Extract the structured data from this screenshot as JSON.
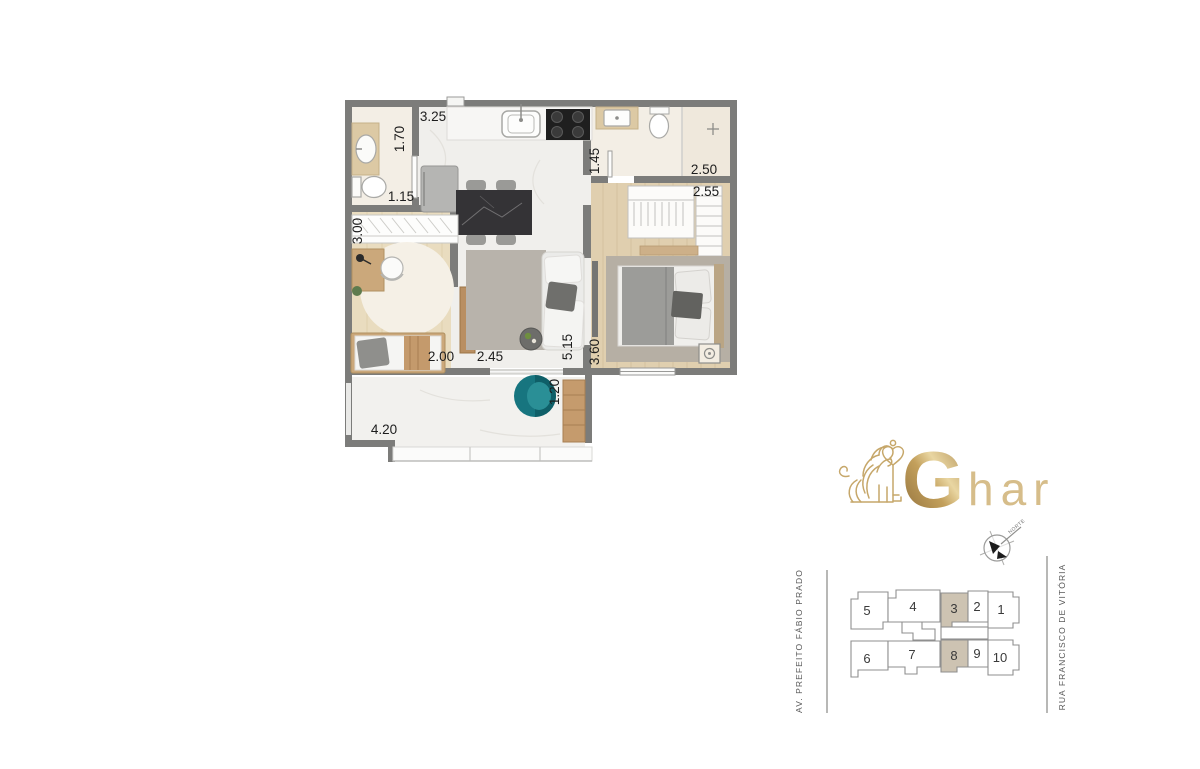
{
  "floor_plan": {
    "dimensions": {
      "kitchen_width": "3.25",
      "bath1_depth": "1.70",
      "bath1_width": "1.15",
      "office_depth": "3.00",
      "office_width": "2.00",
      "living_width": "2.45",
      "living_depth": "5.15",
      "bedroom_depth": "3.60",
      "bath2_depth": "1.45",
      "bath2_width": "2.50",
      "wardrobe_width": "2.55",
      "balcony_depth": "1.20",
      "balcony_width": "4.20"
    },
    "colors": {
      "walls": "#7c7c7a",
      "wood_floor": "#e0cfaf",
      "marble_floor": "#f0efec",
      "bath_floor": "#f3eee5",
      "accent_chair": "#17757f"
    }
  },
  "logo": {
    "initial": "G",
    "suffix": "har",
    "gold": "#c2a262"
  },
  "compass": {
    "label": "NORTE"
  },
  "site_plan": {
    "streets": {
      "left": "AV. PREFEITO FÁBIO PRADO",
      "right": "RUA FRANCISCO DE VITÓRIA"
    },
    "units": [
      {
        "label": "5",
        "highlighted": false
      },
      {
        "label": "4",
        "highlighted": false
      },
      {
        "label": "3",
        "highlighted": true
      },
      {
        "label": "2",
        "highlighted": false
      },
      {
        "label": "1",
        "highlighted": false
      },
      {
        "label": "6",
        "highlighted": false
      },
      {
        "label": "7",
        "highlighted": false
      },
      {
        "label": "8",
        "highlighted": true
      },
      {
        "label": "9",
        "highlighted": false
      },
      {
        "label": "10",
        "highlighted": false
      }
    ],
    "highlight_color": "#cdc3b2"
  }
}
